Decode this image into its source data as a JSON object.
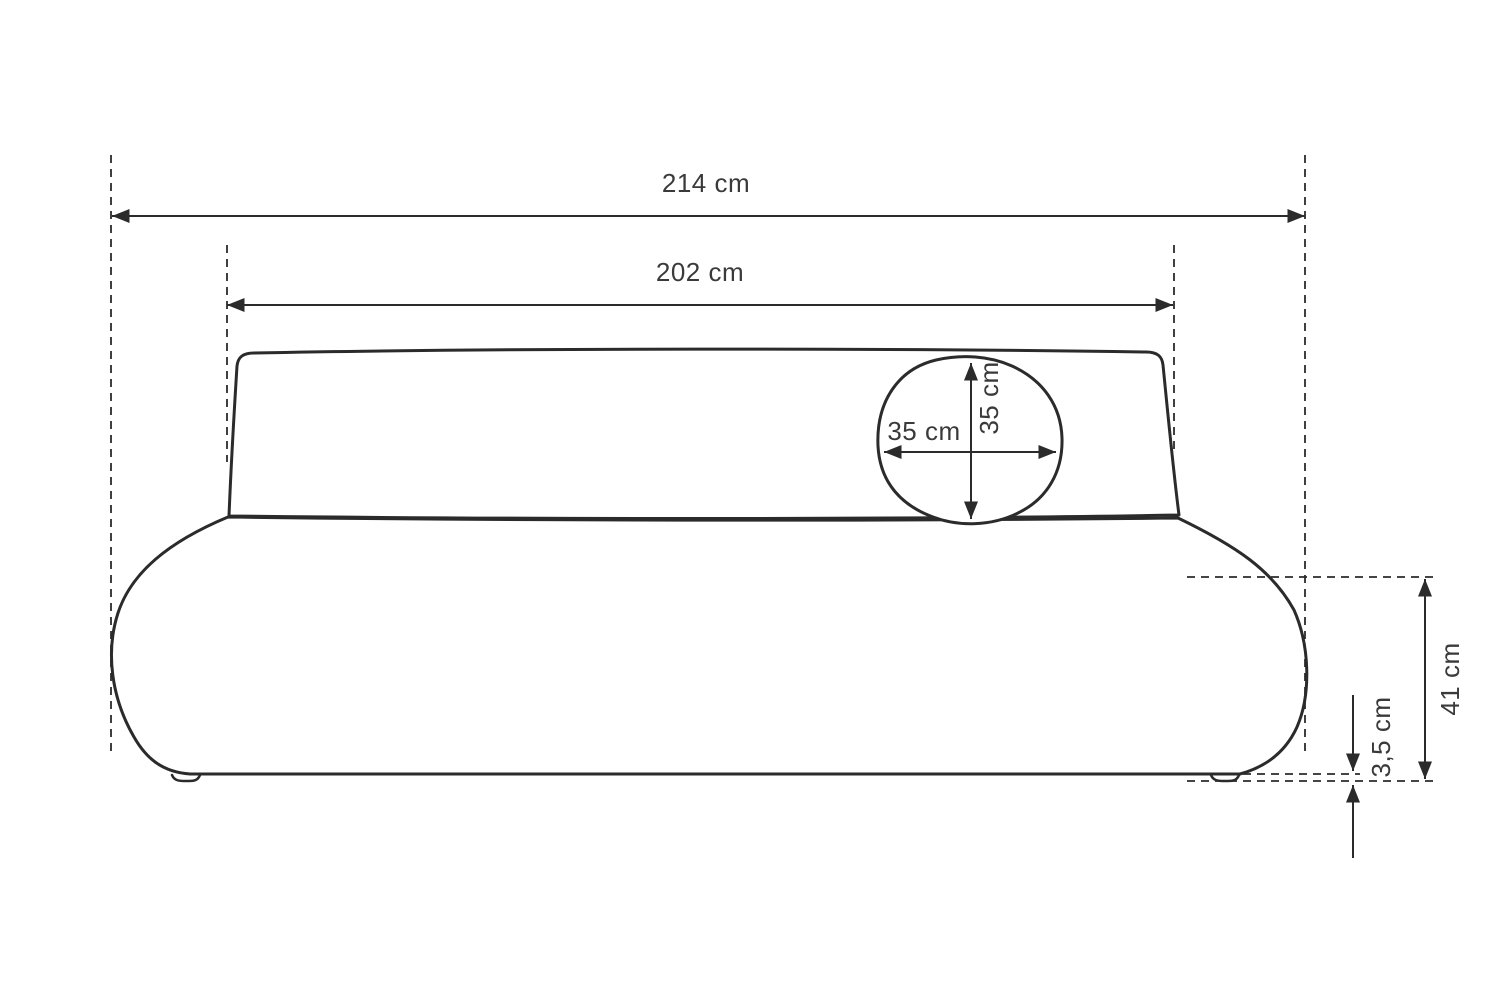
{
  "diagram": {
    "description": "sofa dimension drawing",
    "labels": {
      "overall_width": "214 cm",
      "backrest_width": "202 cm",
      "pillow_width": "35 cm",
      "pillow_height": "35 cm",
      "seat_height": "41 cm",
      "foot_height": "3,5 cm"
    },
    "colors": {
      "line": "#2b2b2b",
      "text": "#3a3a3a",
      "background": "#ffffff"
    }
  }
}
